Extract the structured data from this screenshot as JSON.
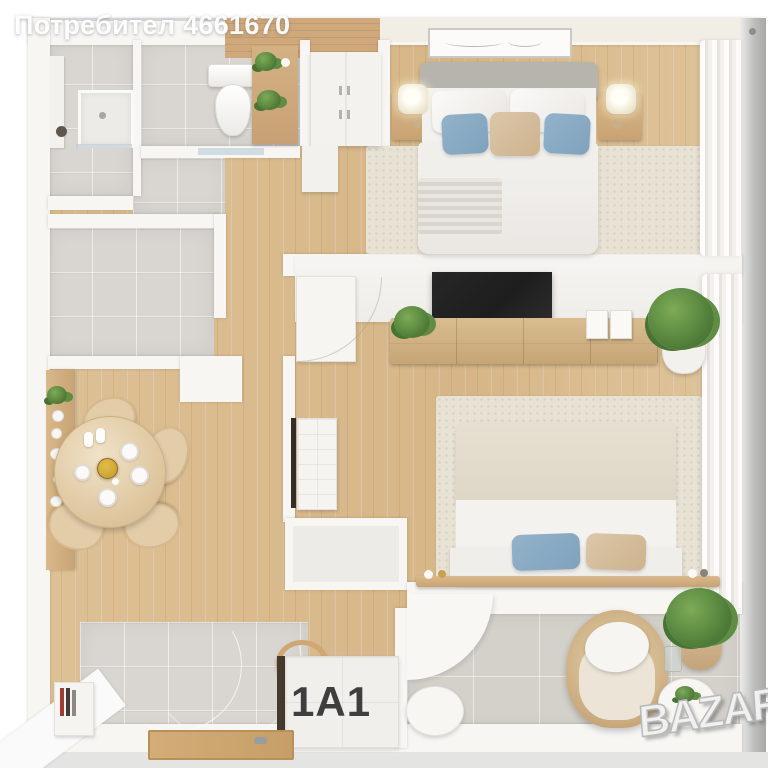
{
  "watermarks": {
    "user": "Потребител 4661670",
    "brand": "BAZAR"
  },
  "unit": {
    "label": "1A1"
  },
  "colors": {
    "wood_floor": "#dcbf93",
    "tile": "#d9d6d1",
    "balcony_tile": "#d4d1cb",
    "wall": "#f7f6f3",
    "outer_wall": "#bdbdbc",
    "rug": "#e8e2d5",
    "accent_blue": "#93b2ca",
    "accent_beige": "#dcc7a9",
    "headboard_gray": "#b7b3ad",
    "plant_green": "#4e7c38",
    "gold": "#c39a2a",
    "tv_black": "#1e1e1e",
    "wicker": "#c9a97c",
    "label_dark": "#3e3e3e"
  }
}
